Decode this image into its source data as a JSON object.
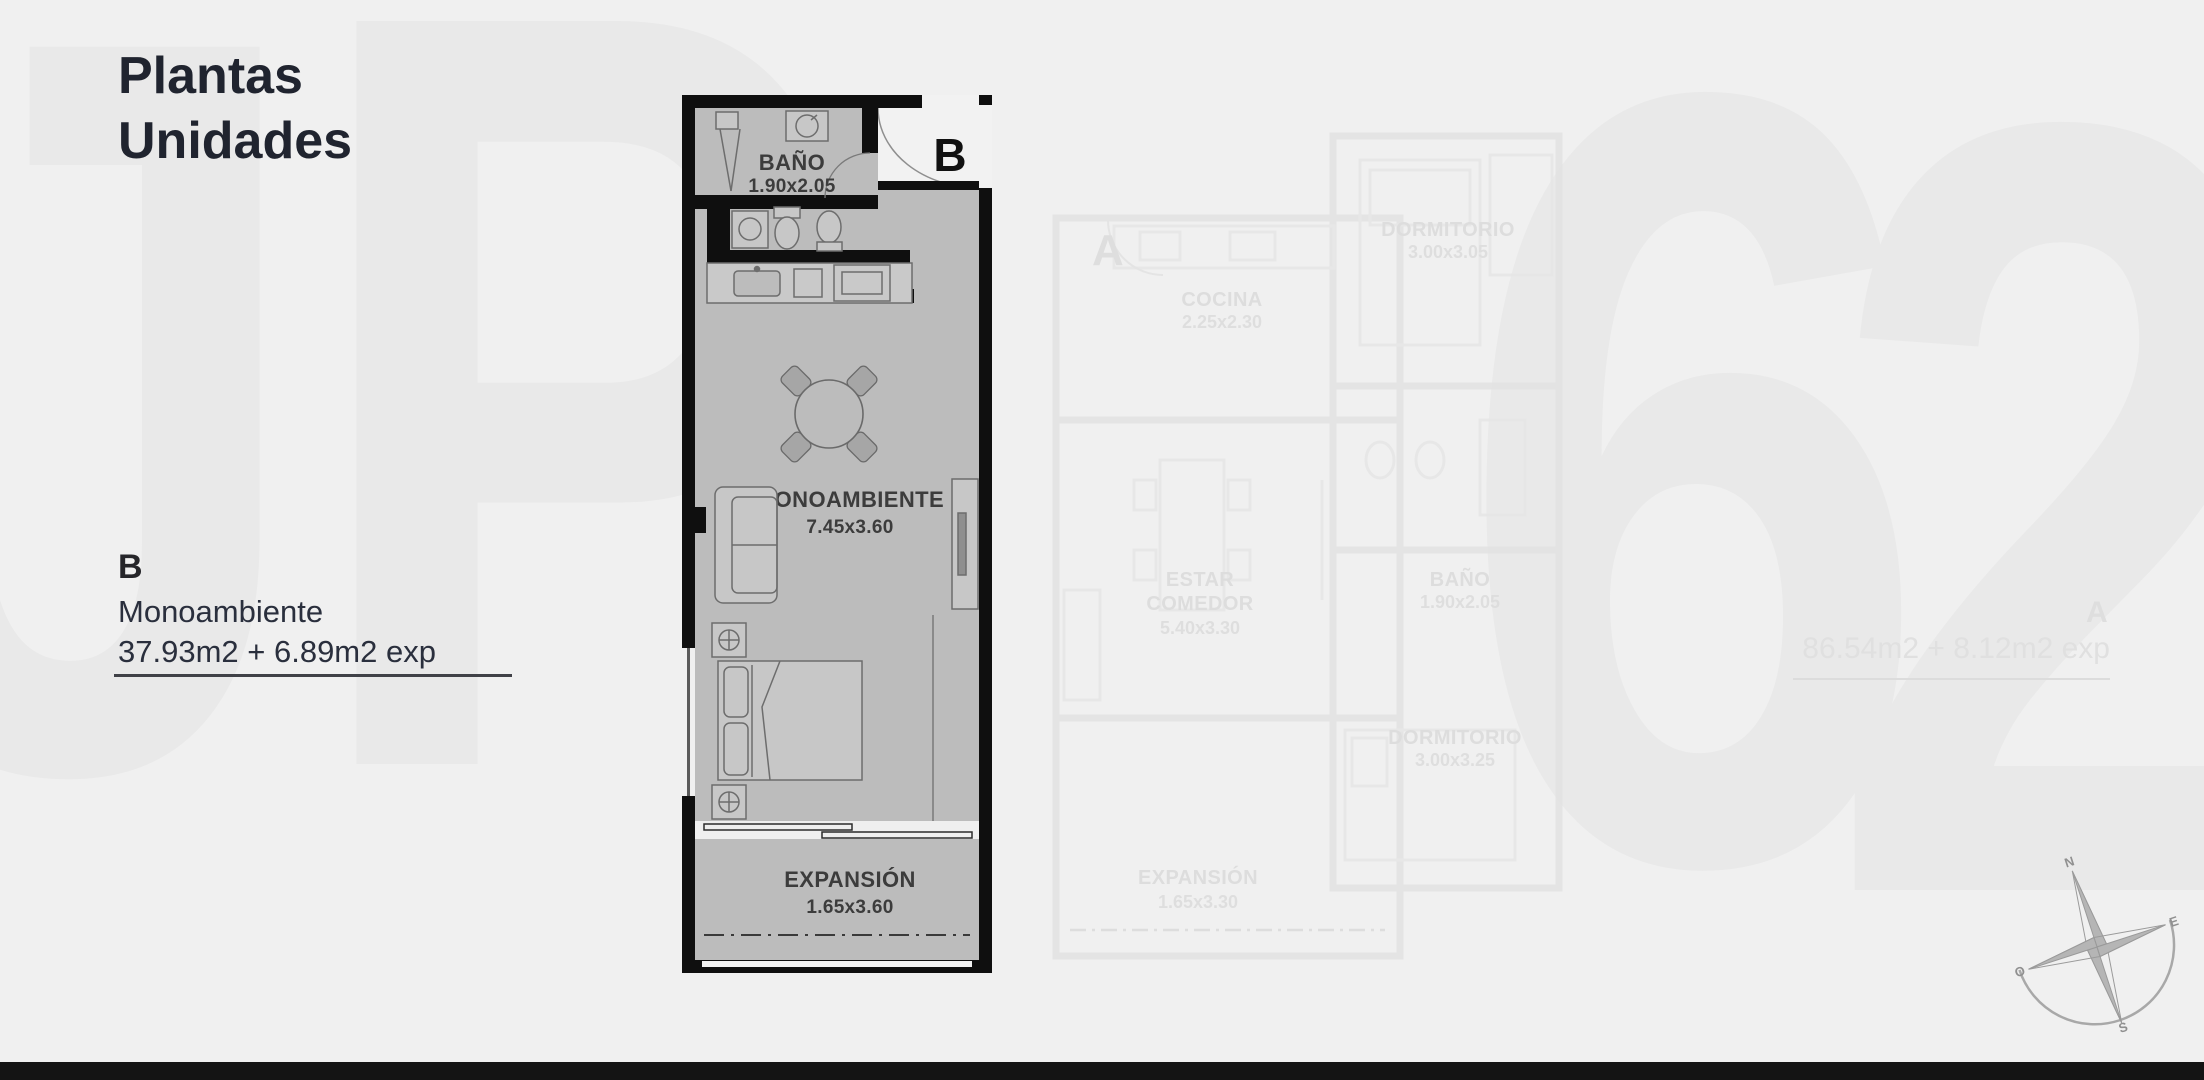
{
  "page": {
    "title_line1": "Plantas",
    "title_line2": "Unidades"
  },
  "watermark": {
    "letter_j": "J",
    "letter_p": "P",
    "digit_6": "6",
    "digit_2": "2"
  },
  "unit_b": {
    "door_label": "B",
    "info": {
      "id": "B",
      "name": "Monoambiente",
      "area": "37.93m2 + 6.89m2 exp"
    },
    "rooms": {
      "bano": {
        "label": "BAÑO",
        "dims": "1.90x2.05"
      },
      "monoambiente": {
        "label": "MONOAMBIENTE",
        "dims": "7.45x3.60"
      },
      "expansion": {
        "label": "EXPANSIÓN",
        "dims": "1.65x3.60"
      }
    }
  },
  "unit_a": {
    "door_label": "A",
    "info": {
      "id": "A",
      "area": "86.54m2 + 8.12m2 exp"
    },
    "rooms": {
      "cocina": {
        "label": "COCINA",
        "dims": "2.25x2.30"
      },
      "dormitorio_1": {
        "label": "DORMITORIO",
        "dims": "3.00x3.05"
      },
      "bano": {
        "label": "BAÑO",
        "dims": "1.90x2.05"
      },
      "estar": {
        "line1": "ESTAR",
        "line2": "COMEDOR",
        "dims": "5.40x3.30"
      },
      "dormitorio_2": {
        "label": "DORMITORIO",
        "dims": "3.00x3.25"
      },
      "expansion": {
        "label": "EXPANSIÓN",
        "dims": "1.65x3.30"
      }
    }
  },
  "compass": {
    "n": "N",
    "e": "E",
    "s": "S",
    "o": "O"
  },
  "colors": {
    "wall": "#0f0f0f",
    "floor": "#bcbcbc",
    "title_text": "#20242f",
    "ghost": "#e2e2e2",
    "background": "#f0f0f0"
  }
}
